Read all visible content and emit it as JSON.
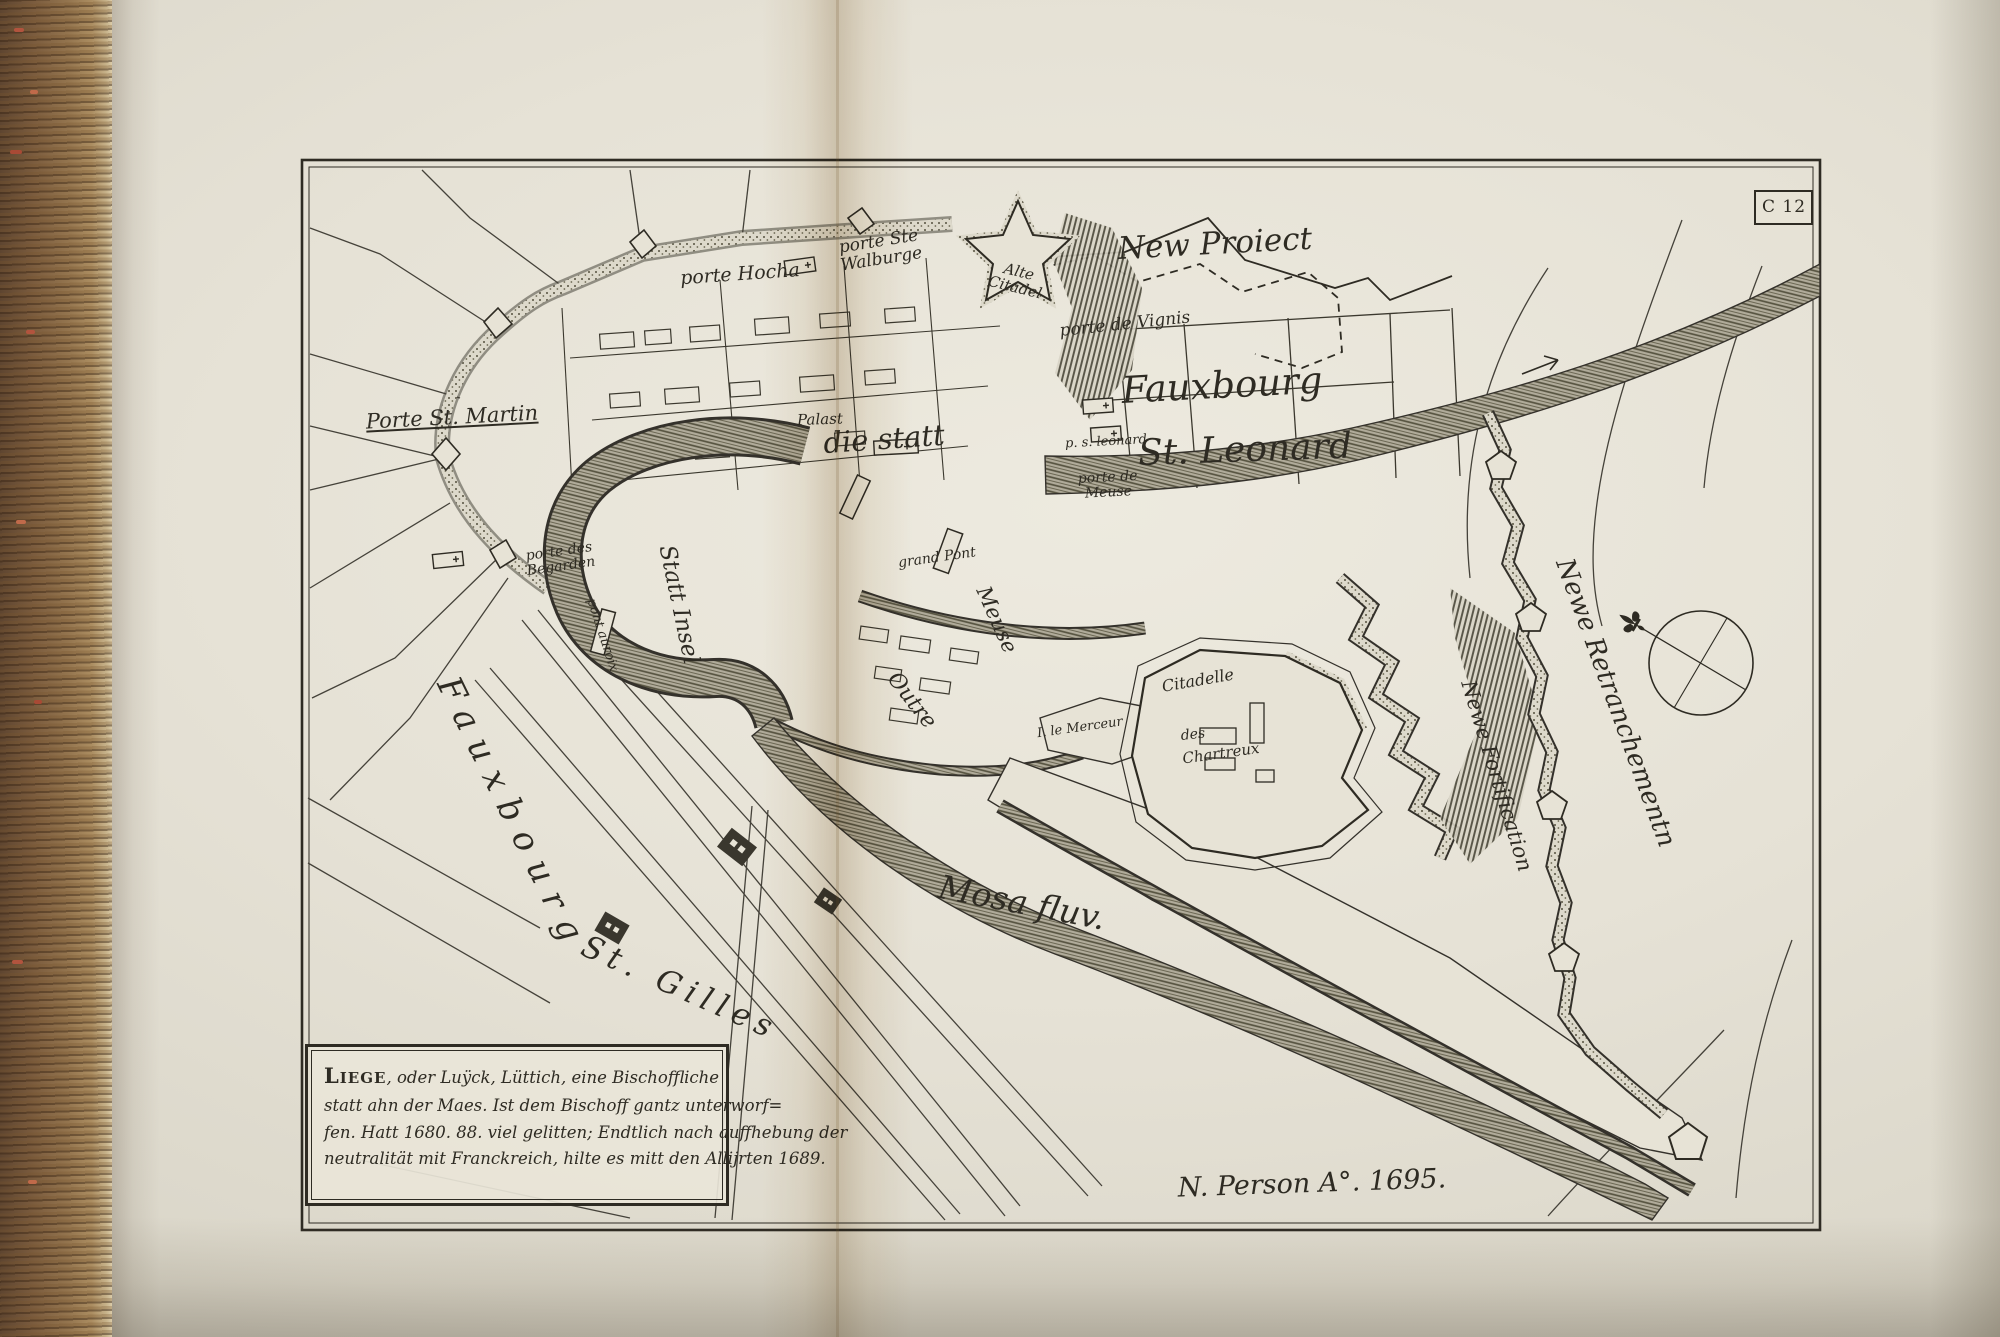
{
  "plate_mark": "C 12",
  "colors": {
    "ink": "#2e2b23",
    "paper": "#e7e3d6",
    "water_hatch": "#55523f",
    "book_edge_brown": "#8a6a48"
  },
  "cartouche": {
    "lead": "Liege",
    "line1_rest": ", oder Luÿck, Lüttich, eine Bischoffliche",
    "line2": "statt ahn der Maes. Ist dem Bischoff gantz unterworf=",
    "line3": "fen. Hatt 1680. 88. viel gelitten; Endtlich nach auffhebung der",
    "line4": "neutralität mit Franckreich, hilte es mitt den Allijrten 1689."
  },
  "signature": "N. Person A°. 1695.",
  "labels": {
    "new_proiect": "New Proiect",
    "porte_hocha": "porte Hocha",
    "porte_ste": "porte Ste",
    "walburge": "Walburge",
    "alte": "Alte",
    "citadel": "Citadel",
    "porte_de_vignis": "porte de Vignis",
    "fauxbourg_leonard": "Fauxbourg",
    "p_s_leonard": "p. s. leonard",
    "st_leonard": "St. Leonard",
    "porte_de": "porte de",
    "meuse_gate": "Meuse",
    "porte_st_martin": "Porte St. Martin",
    "palast": "Palast",
    "die_statt": "die statt",
    "porte_des": "porte des",
    "begarden": "Begarden",
    "pont_auroix": "pont auroix",
    "statt_insel": "Statt Insel",
    "grand_pont": "grand Pont",
    "meuse_island": "Meuse",
    "outre": "Outre",
    "ile_le_merceur": "I. le Merceur",
    "citadelle": "Citadelle",
    "des": "des",
    "chartreux": "Chartreux",
    "newe_retranchementn": "Newe Retranchementn",
    "newe_fortification": "Newe Fortification",
    "mosa_fluv": "Mosa fluv.",
    "fauxbourg_gilles": "Fauxbourg",
    "st_gilles": "St. Gilles"
  }
}
